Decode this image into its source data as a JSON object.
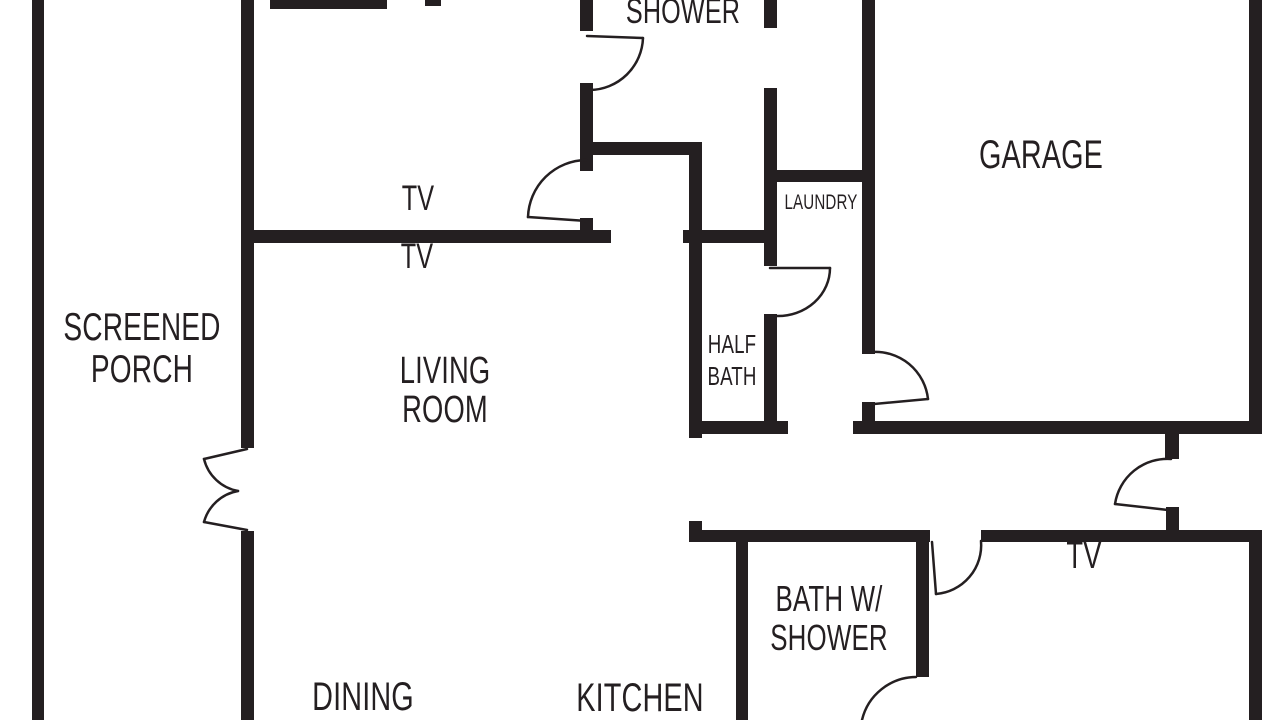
{
  "document": {
    "type": "residential floor plan drawing",
    "view": "top-down plan, cropped at top, bottom and right edges"
  },
  "colors": {
    "wall": "#241f21",
    "background": "#ffffff",
    "text": "#241f21"
  },
  "labels": {
    "shower_room": "SHOWER",
    "tv_upper": "TV",
    "tv_living": "TV",
    "screened_porch": "SCREENED\nPORCH",
    "living_room": "LIVING\nROOM",
    "half_bath": "HALF\nBATH",
    "laundry": "LAUNDRY",
    "garage": "GARAGE",
    "bath_with_shower": "BATH W/\nSHOWER",
    "tv_bedroom": "TV",
    "dining": "DINING",
    "kitchen": "KITCHEN"
  }
}
